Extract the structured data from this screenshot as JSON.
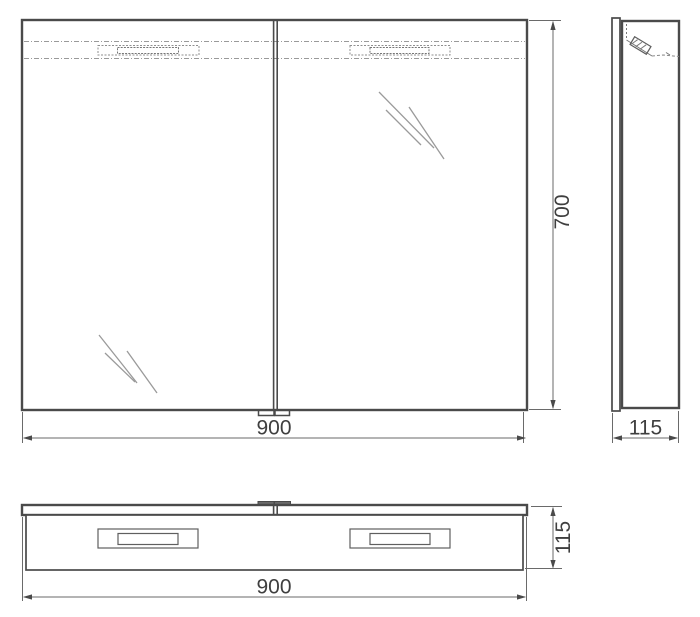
{
  "title": "Mirror cabinet technical drawing, three orthographic views",
  "colors": {
    "background": "#ffffff",
    "outline": "#4a4a4a",
    "dimension": "#6a6a6a",
    "hidden_line": "#9a9a9a",
    "text": "#3f3f3f"
  },
  "views": {
    "front": {
      "name": "front view",
      "width_label": "900",
      "height_label": "700"
    },
    "side": {
      "name": "side view",
      "depth_label": "115"
    },
    "top": {
      "name": "top view",
      "width_label": "900",
      "depth_label": "115"
    }
  }
}
